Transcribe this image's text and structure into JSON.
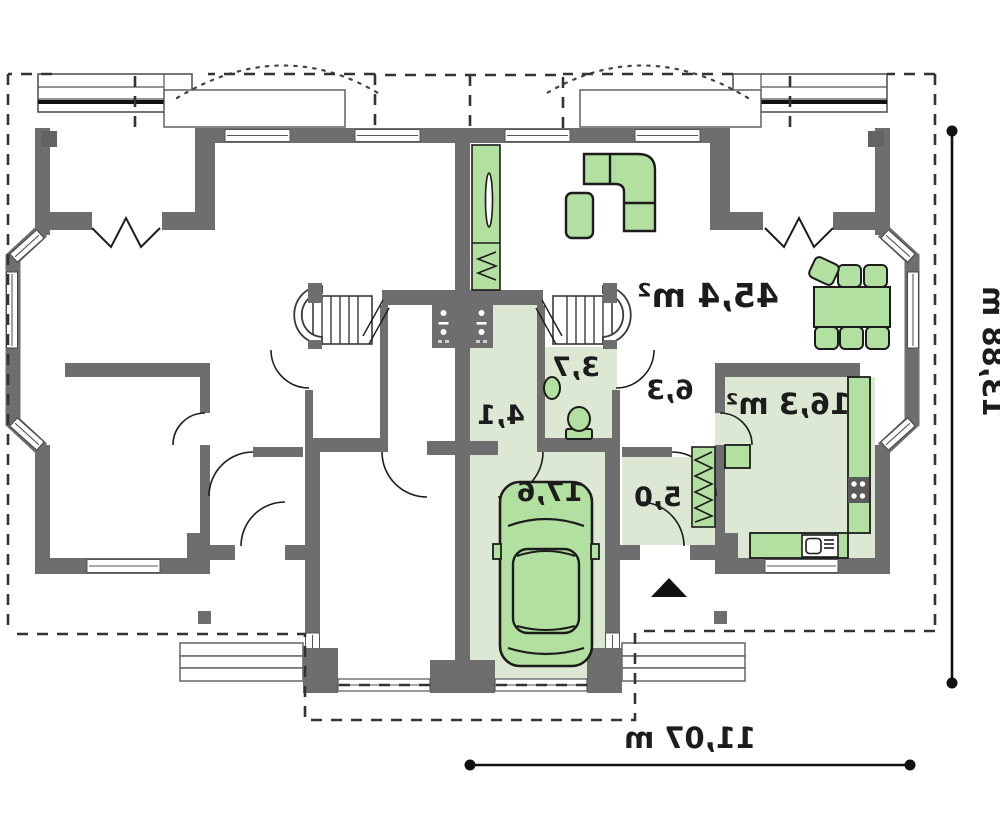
{
  "plan": {
    "type": "floor-plan-mirrored",
    "rooms": {
      "living_room": {
        "label": "45,4 m²"
      },
      "kitchen": {
        "label": "16,3 m²"
      },
      "bathroom": {
        "label": "3,7"
      },
      "hall": {
        "label": "6,3"
      },
      "utility": {
        "label": "4,1"
      },
      "corridor": {
        "label": "5,0"
      },
      "garage": {
        "label": "17,6"
      }
    },
    "dimensions": {
      "total_width": {
        "label": "11,07 m"
      },
      "total_depth": {
        "label": "13,88 m"
      }
    },
    "colors": {
      "wall": "#6e6e6e",
      "floor_green": "#dce8d3",
      "furniture": "#b2e0a0",
      "outline": "#1c1c1c",
      "dash": "#333333"
    }
  }
}
